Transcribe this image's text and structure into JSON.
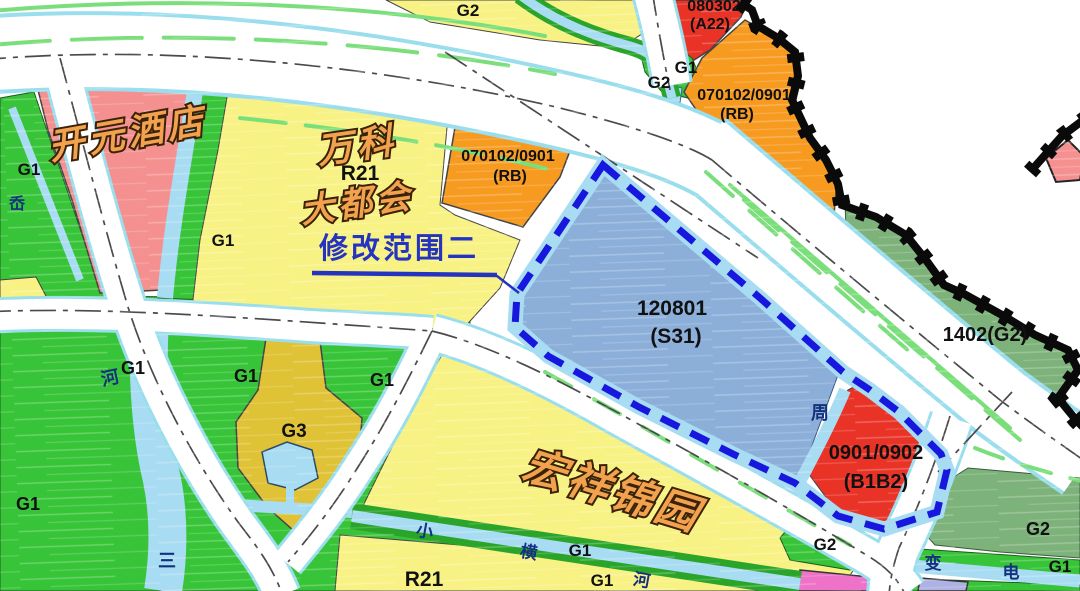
{
  "map": {
    "labels": {
      "kaiyuan_hotel": "开元酒店",
      "vanke": "万科",
      "metropolis": "大都会",
      "mod_scope": "修改范围二",
      "hongxiang_jinyuan": "宏祥锦园",
      "code_rb": "070102/0901",
      "use_rb": "(RB)",
      "code_a22": "080302",
      "use_a22": "(A22)",
      "code_s31": "120801",
      "use_s31": "(S31)",
      "code_b1b2": "0901/0902",
      "use_b1b2": "(B1B2)",
      "code_1402": "1402(G2)",
      "r21": "R21",
      "g1": "G1",
      "g2": "G2",
      "g3": "G3",
      "zhou": "周",
      "river": "河",
      "san": "三",
      "ao": "岙",
      "xiao": "小",
      "heng": "横",
      "bian": "变",
      "dian": "电"
    },
    "colors": {
      "g1_green": "#38c438",
      "bank_green": "#2aa52a",
      "stripe_green": "#7ade7a",
      "yellow": "#f8f284",
      "gold": "#dfc235",
      "pink": "#f59090",
      "water": "#a8dcf2",
      "parcel_blue": "#8bafd9",
      "red": "#e93327",
      "orange": "#f79a20",
      "sage": "#7db27a",
      "magenta": "#ee72c8",
      "lavender": "#aeb2e2",
      "boundary_blue": "#1717dd",
      "road_casing": "#9adeed",
      "centerline": "#4a4a4a",
      "boundary_black": "#0a0a0a"
    }
  }
}
